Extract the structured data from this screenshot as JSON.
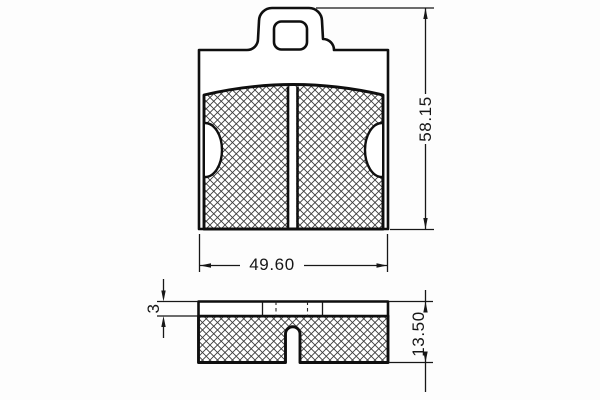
{
  "drawing": {
    "dimensions": {
      "pad_width": "49.60",
      "pad_height": "58.15",
      "backplate_thickness": "3",
      "total_thickness": "13.50"
    }
  }
}
